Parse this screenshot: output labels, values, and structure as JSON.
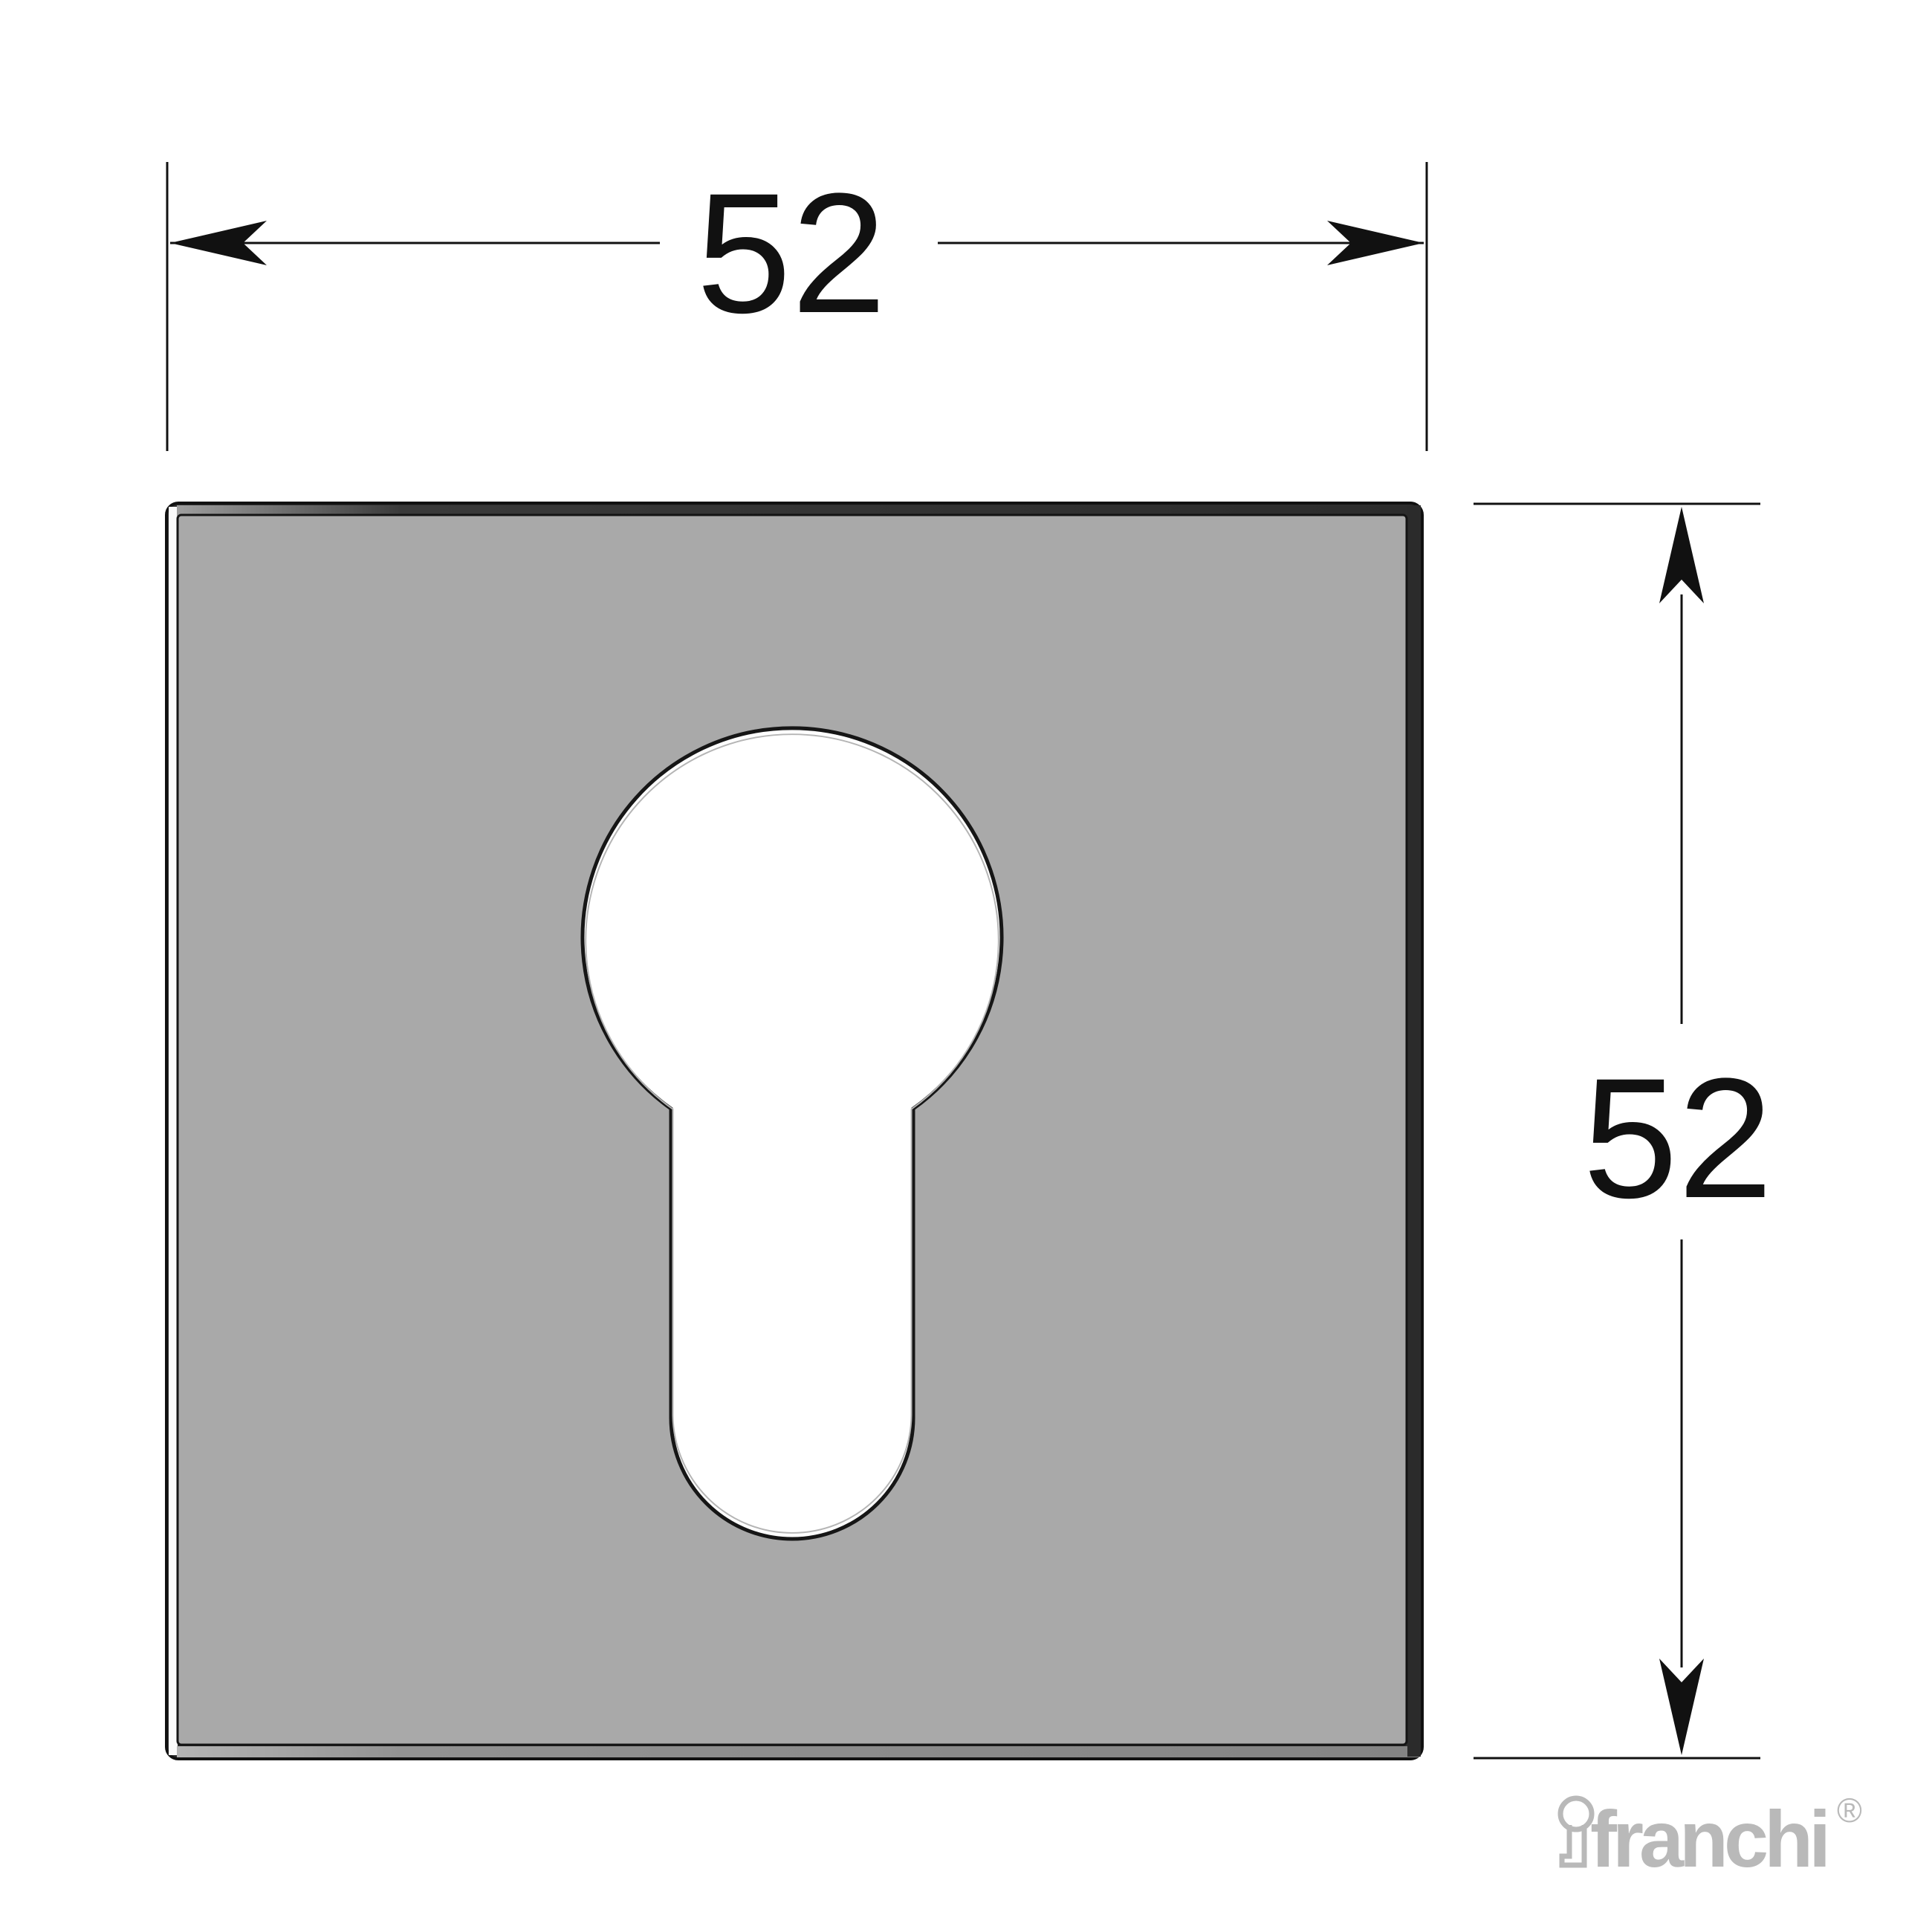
{
  "drawing": {
    "width_dimension": {
      "value": "52"
    },
    "height_dimension": {
      "value": "52"
    }
  },
  "logo": {
    "brand": "franchi",
    "registered": "®"
  },
  "colors": {
    "background": "#ffffff",
    "plate_fill": "#a9a9a9",
    "plate_base": "#2e2e2e",
    "outline": "#111111",
    "face_outline": "#141414",
    "bevel_left": "#fafafa",
    "bevel_top_light": "#9e9e9e",
    "bevel_top_mid": "#3a3a3a",
    "bevel_top_dark": "#2c2c2c",
    "bevel_right": "#2b2b2b",
    "bevel_bottom_light": "#b4b4b4",
    "bevel_bottom_mid": "#929292",
    "bevel_bottom_dark": "#848484",
    "keyhole_fill": "#ffffff",
    "keyhole_chamfer": "#b5b5b5",
    "dimension_line": "#111111",
    "logo_gray": "#b9b9b9"
  }
}
